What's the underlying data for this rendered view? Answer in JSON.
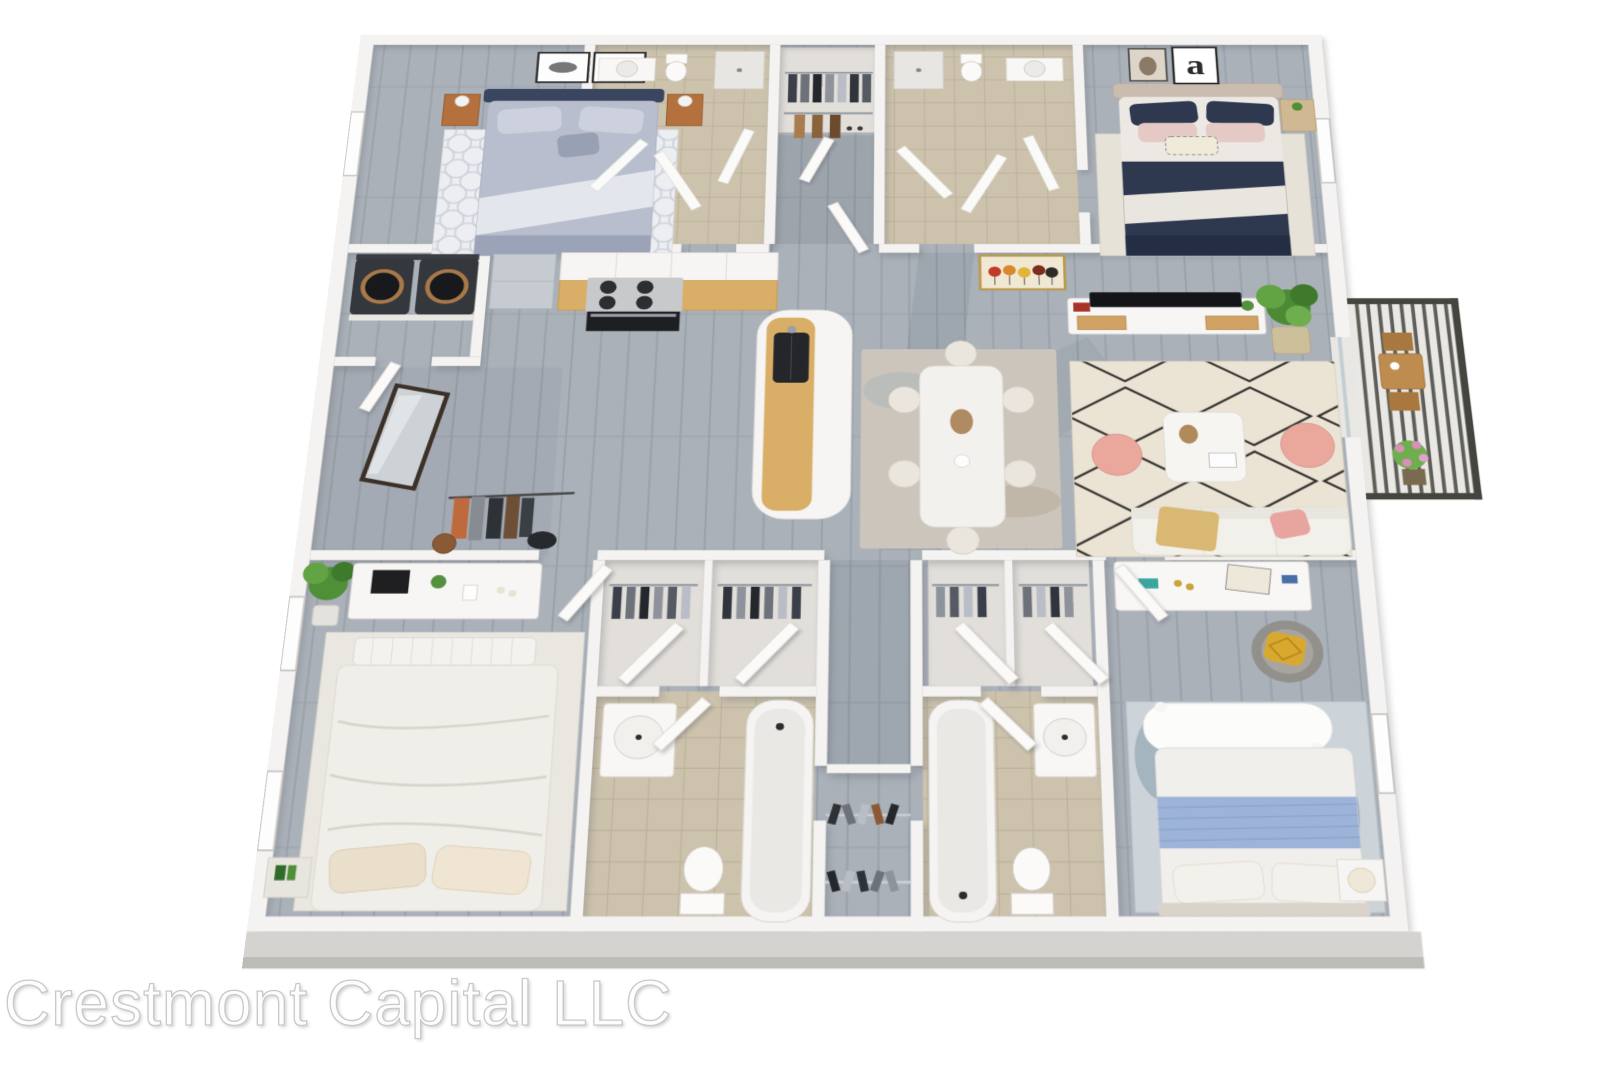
{
  "watermark": {
    "text": "Crestmont Capital LLC"
  },
  "artwork": {
    "letter_print": "a"
  },
  "scene": {
    "kind": "3d-isometric-floor-plan-rendering",
    "background": "#ffffff",
    "rooms": [
      {
        "name": "bedroom-top-left",
        "furnishings": [
          "bed with navy headboard and gray bedding",
          "two monochrome framed prints",
          "two wood nightstands with lamps",
          "lattice pattern rug",
          "window on left wall"
        ]
      },
      {
        "name": "bathroom-top-left",
        "furnishings": [
          "vanity with round basin",
          "toilet",
          "shower",
          "tile floor",
          "open doors"
        ]
      },
      {
        "name": "hall-closet-top",
        "furnishings": [
          "closet with hanging clothes",
          "coat rack"
        ]
      },
      {
        "name": "bathroom-top-right",
        "furnishings": [
          "shower",
          "toilet",
          "vanity",
          "tile floor"
        ]
      },
      {
        "name": "bedroom-top-right",
        "furnishings": [
          "bed with beige headboard, navy and blush bedding",
          "horse photo print",
          "letter-a print",
          "light wood nightstand with plant",
          "window on right wall"
        ]
      },
      {
        "name": "laundry",
        "furnishings": [
          "washer",
          "dryer"
        ]
      },
      {
        "name": "kitchen",
        "furnishings": [
          "stainless fridge",
          "white upper cabinets",
          "gas cooktop with four burners",
          "oven",
          "wood counter",
          "double sink with faucet",
          "curved island bar"
        ]
      },
      {
        "name": "entry",
        "furnishings": [
          "leaning mirror with dark frame",
          "coat rack with orange, gray and black garments",
          "basket",
          "bag"
        ]
      },
      {
        "name": "dining-area",
        "furnishings": [
          "white rectangular table",
          "six cream chairs",
          "muted beige-blue rug",
          "centerpiece"
        ]
      },
      {
        "name": "living-room",
        "furnishings": [
          "colorful framed art",
          "tv on white and wood media console",
          "potted fiddle-leaf plant",
          "cream rug with black diamond pattern",
          "white coffee table with flowers and book",
          "two pink round poufs",
          "cream sofa with yellow throw and pink pillow"
        ]
      },
      {
        "name": "balcony",
        "furnishings": [
          "dark slatted metal railing",
          "wood bistro table with two chairs",
          "flowering pink plant"
        ]
      },
      {
        "name": "bedroom-bottom-left",
        "furnishings": [
          "white dresser with framed photo and plants",
          "potted plant",
          "white slatted bench",
          "bed with cream bedding",
          "patterned rug",
          "nightstand with green books",
          "two windows on left wall"
        ]
      },
      {
        "name": "closets-bottom-left",
        "furnishings": [
          "two closets with hanging dark clothes",
          "angled open doors"
        ]
      },
      {
        "name": "bathroom-bottom-left",
        "furnishings": [
          "vanity with round basin",
          "toilet",
          "bathtub",
          "tan tile floor"
        ]
      },
      {
        "name": "closet-bottom-center",
        "furnishings": [
          "hanging clothes on two rods",
          "shelf"
        ]
      },
      {
        "name": "closets-bottom-right",
        "furnishings": [
          "two closets with hanging gray clothes",
          "angled open doors"
        ]
      },
      {
        "name": "bathroom-bottom-right",
        "furnishings": [
          "bathtub",
          "toilet",
          "vanity with round basin",
          "tan tile floor"
        ]
      },
      {
        "name": "bedroom-bottom-right",
        "furnishings": [
          "floating white desk shelf with decor",
          "gray armchair with yellow pillow",
          "white fur bench",
          "bed with white duvet and blue throw",
          "blue abstract rug",
          "nightstand with lamp",
          "window on right wall"
        ]
      }
    ]
  },
  "palette": {
    "floor_plank": "#aab1b9",
    "wall": "#f4f3f1",
    "tile": "#cdc3ad",
    "counter_wood": "#d9ae66",
    "navy": "#2e3950",
    "blush": "#eaa89d",
    "plant_green": "#4f8f38",
    "balcony_rail": "#45453f",
    "slab_edge": "#d5d3d0",
    "watermark_gray": "#c9c9c9"
  }
}
